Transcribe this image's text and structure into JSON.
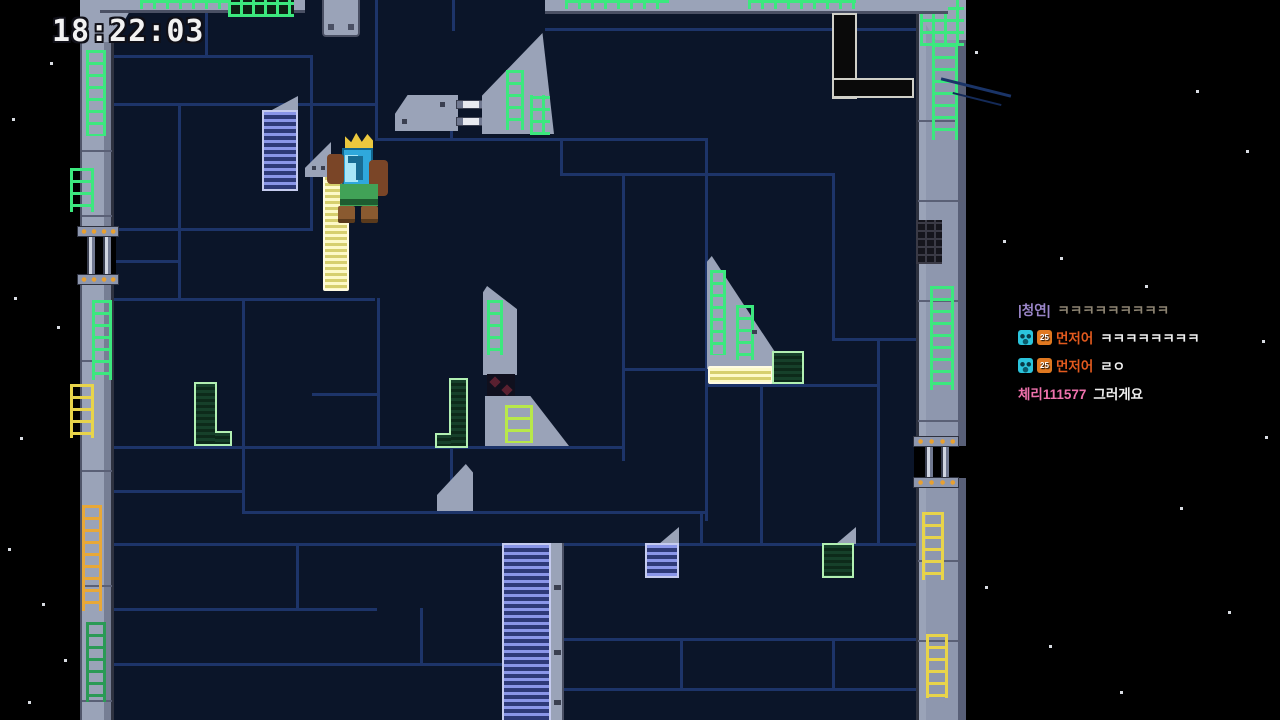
{
  "hud": {
    "timer_label": "18:22:03"
  },
  "chat": {
    "badges": {
      "subscriber_color": "#2bc4dc",
      "level_label": "25",
      "level_color": "#e07820"
    },
    "messages": [
      {
        "username": "|청연|",
        "username_color": "#9b86c9",
        "text": "ㅋㅋㅋㅋㅋㅋㅋㅋㅋ",
        "text_color": "#8d8472"
      },
      {
        "username": "먼저어",
        "username_color": "#e25a1e",
        "text": "ㅋㅋㅋㅋㅋㅋㅋㅋ",
        "text_color": "#efefef"
      },
      {
        "username": "먼저어",
        "username_color": "#e25a1e",
        "text": "ㄹㅇ",
        "text_color": "#efefef"
      },
      {
        "username": "체리111577",
        "username_color": "#ef72ad",
        "text": "그러게요",
        "text_color": "#efefef"
      }
    ]
  },
  "game": {
    "player": {
      "name": "crowned-king-character",
      "skin_colors": {
        "crown": "#ecc83e",
        "head": "#2fa8dc",
        "fur": "#7a4527",
        "tunic": "#41a257"
      }
    },
    "palette": {
      "background_navy": "#0b1529",
      "grid_line": "#1d3469",
      "wall_gray": "#9aa3b8",
      "circuit_green": "#3ce87e",
      "ladder_yellow": "#e8d44a",
      "ladder_orange": "#e8a838",
      "platform_yellow": "#f7f3b0",
      "platform_blue": "#8a96e8",
      "outline_green": "#b2f0b2"
    }
  }
}
